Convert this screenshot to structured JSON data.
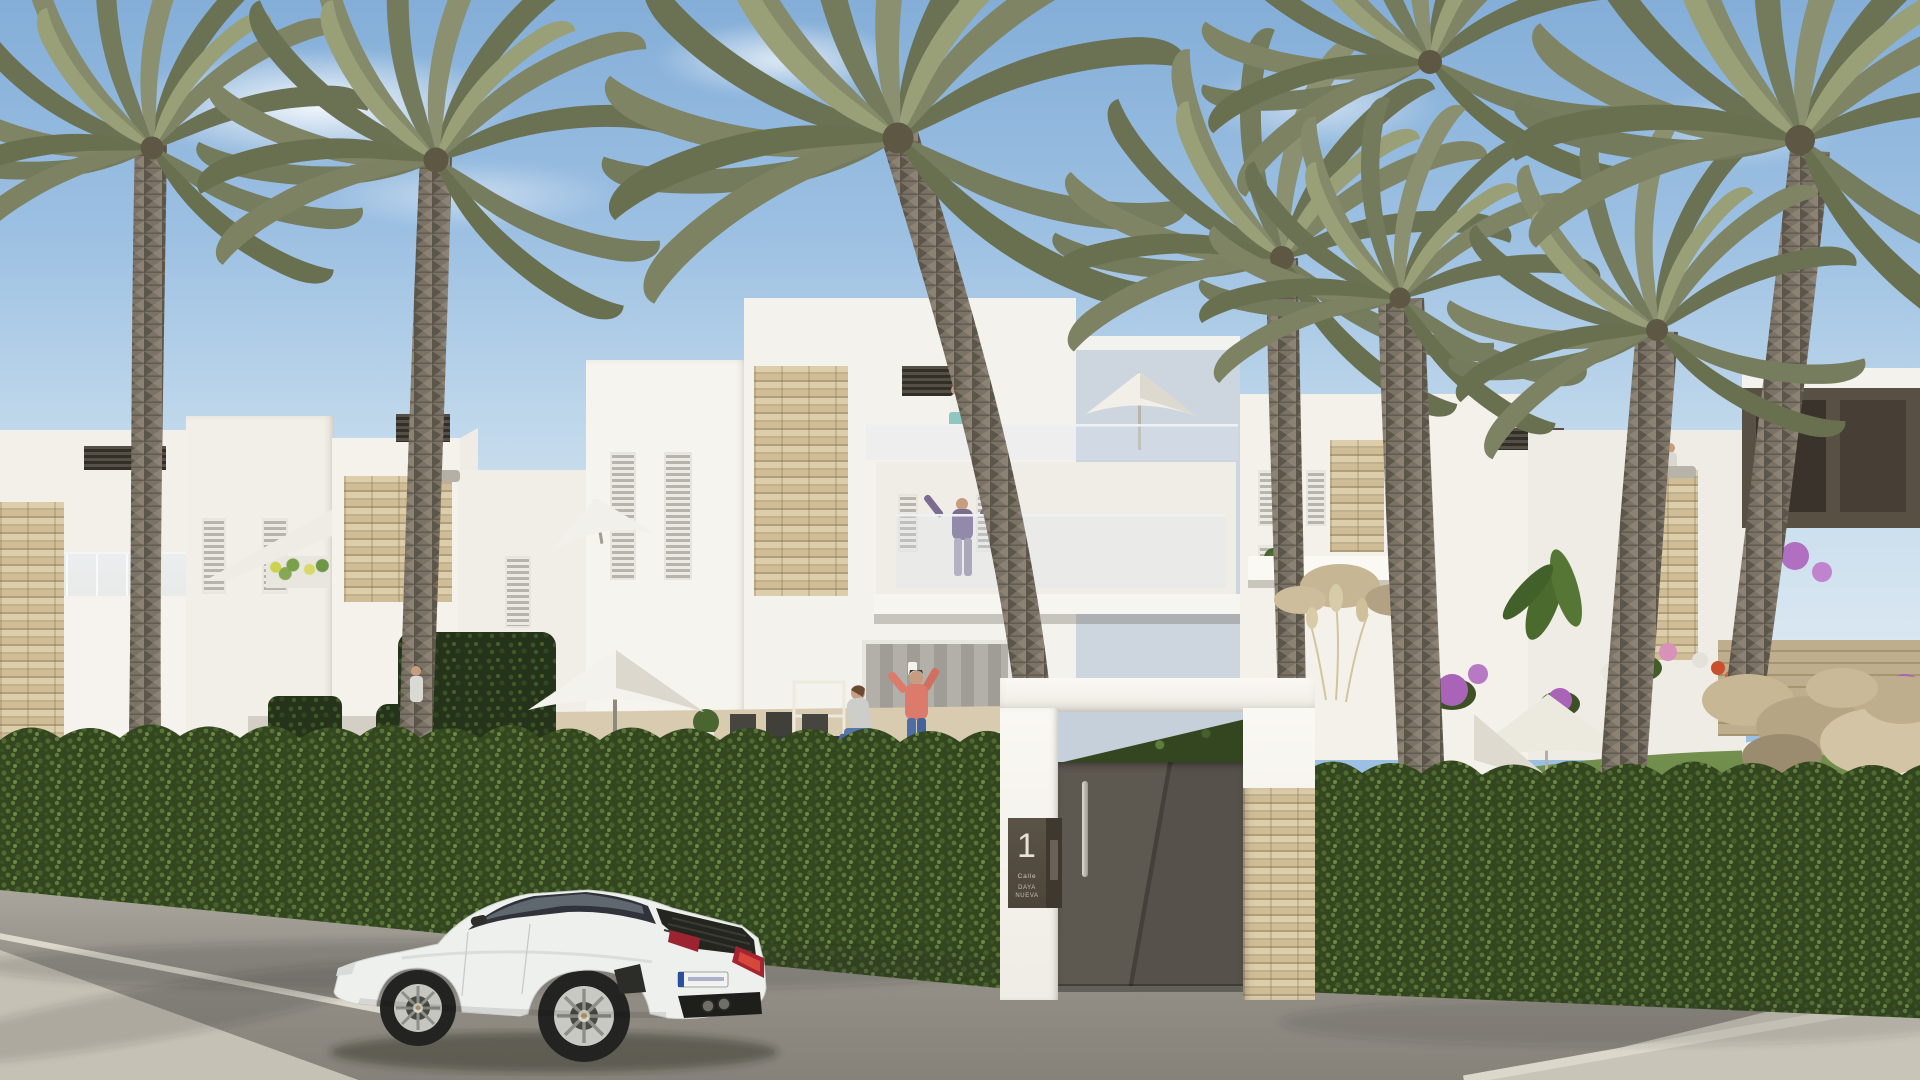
{
  "scene": {
    "setting": "sunny residential street of white modern townhouses with palm trees",
    "people_count": 9,
    "objects": [
      "sky",
      "clouds",
      "palm-trees",
      "white-apartment-buildings",
      "stone-clad-accent-walls",
      "louvered-shutters",
      "glass-balustrades",
      "roof-terraces",
      "patio-with-dining-set",
      "garden-lawn",
      "boxwood-hedge",
      "entrance-gate",
      "street",
      "sidewalk",
      "white-sports-car",
      "people",
      "parasols",
      "sun-loungers",
      "flower-shrubs",
      "rock-wall"
    ]
  },
  "gate": {
    "plaque": {
      "number": "1",
      "street_label": "Calle",
      "street_name": "DAYA NUEVA"
    }
  },
  "car": {
    "color": "white",
    "plate_style": "EU white plate with blue band"
  },
  "palette": {
    "sky_top": "#84aed8",
    "sky_horizon": "#dfeaf2",
    "building_white": "#f3f0ea",
    "building_shadow": "#ddd9d0",
    "building_blue_shade": "#cdd6df",
    "stone": "#c9b58e",
    "hedge_green": "#33461f",
    "lawn_green": "#6e8c4a",
    "palm_frond": "#7e8464",
    "palm_trunk": "#7b7266",
    "street_gray": "#908c84",
    "sidewalk_gray": "#c7c2b6",
    "gate_door": "#56514a",
    "car_body": "#eef0ee",
    "taillight_red": "#a32531",
    "shirt_coral": "#dc7a6c"
  }
}
